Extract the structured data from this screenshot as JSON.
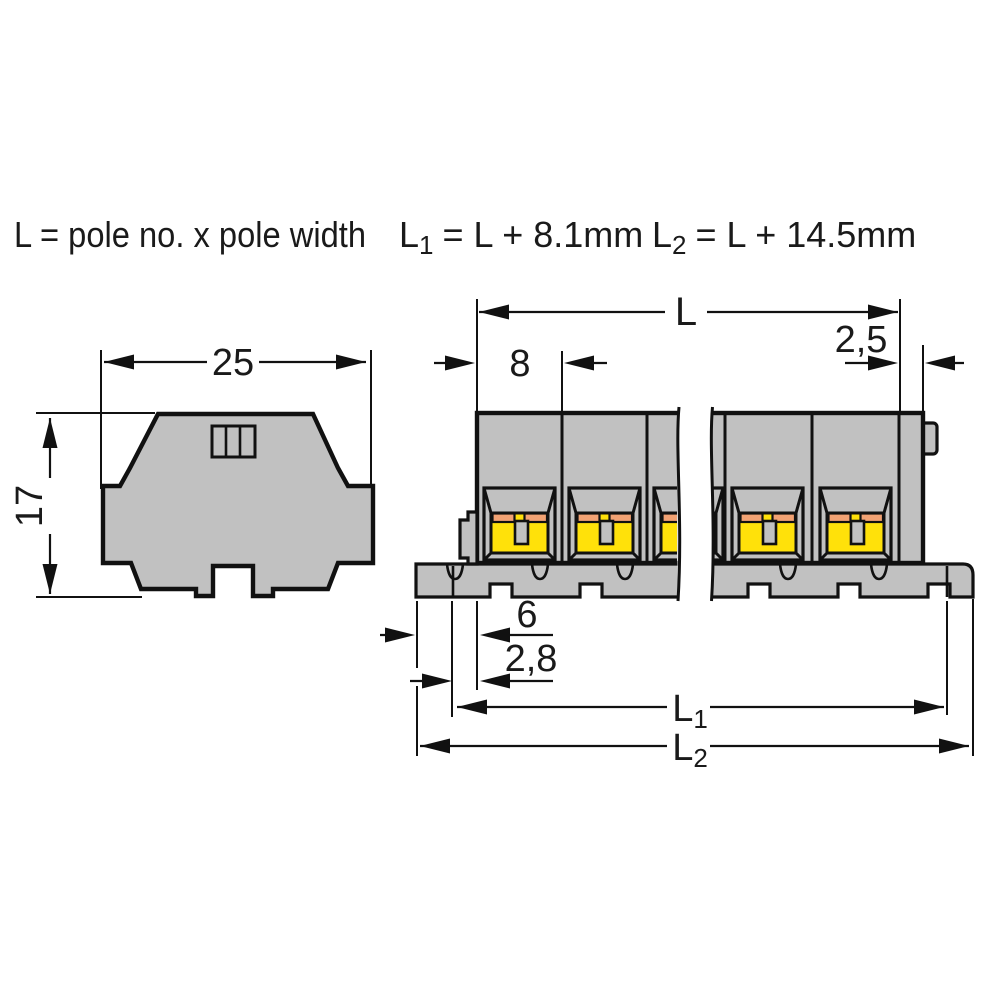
{
  "formulas": {
    "pole_formula": "L = pole no. x pole width",
    "l1_formula": {
      "base": "L",
      "sub": "1",
      "rest": "= L + 8.1mm"
    },
    "l2_formula": {
      "base": "L",
      "sub": "2",
      "rest": "= L + 14.5mm"
    }
  },
  "side_view": {
    "width": "25",
    "height": "17"
  },
  "front_view": {
    "length": "L",
    "pole_width": "8",
    "end_plate": "2,5",
    "foot_depth": "6",
    "foot_offset": "2,8",
    "l1": {
      "base": "L",
      "sub": "1"
    },
    "l2": {
      "base": "L",
      "sub": "2"
    }
  },
  "colors": {
    "body_gray": "#c1c1c1",
    "clamp_yellow": "#ffe10a",
    "contact_orange": "#f2a273",
    "outline": "#111111",
    "text_color": "#1a1a1a",
    "background": "#ffffff"
  }
}
